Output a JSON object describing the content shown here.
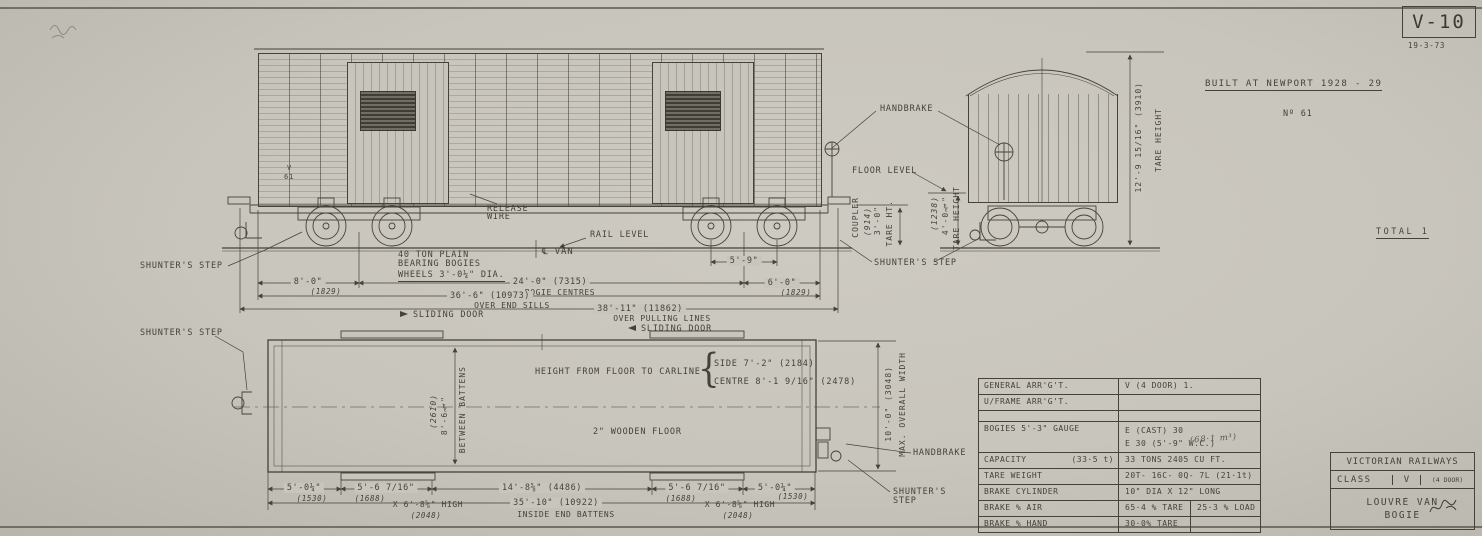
{
  "meta": {
    "drawing_no": "V-10",
    "date": "19-3-73",
    "built_at": "BUILT AT NEWPORT 1928 - 29",
    "unit_no": "Nº 61",
    "total": "TOTAL 1"
  },
  "side": {
    "shunters_step": "SHUNTER'S STEP",
    "bogies_line1": "40 TON PLAIN",
    "bogies_line2": "BEARING BOGIES",
    "wheels": "WHEELS 3'-0¼\" DIA.",
    "release_line1": "RELEASE",
    "release_line2": "WIRE",
    "rail_level": "RAIL LEVEL",
    "cl_van": "℄ VAN",
    "handbrake": "HANDBRAKE",
    "floor_level": "FLOOR LEVEL",
    "shunters_step_mid": "SHUNTER'S STEP",
    "body_class": "V",
    "body_no": "61",
    "dim_8ft": "8'-0\"",
    "dim_8ft_mm": "(1829)",
    "dim_5ft9": "5'-9\"",
    "dim_bogie_centres": "24'-0\" (7315)",
    "lbl_bogie_centres": "BOGIE CENTRES",
    "dim_6ft": "6'-0\"",
    "dim_6ft_mm": "(1829)",
    "dim_end_sills": "36'-6\" (10973)",
    "lbl_end_sills": "OVER END SILLS",
    "dim_pulling": "38'-11\" (11862)",
    "lbl_pulling": "OVER PULLING LINES",
    "coupler": "COUPLER",
    "coupler_mm": "(914)",
    "coupler_ht": "3'-0\"",
    "coupler_lbl": "TARE HT.",
    "floor_mm": "(1238)",
    "floor_ht": "4'-0¾\"",
    "floor_lbl": "TARE HEIGHT"
  },
  "end": {
    "tare_dim": "12'-9 15/16\" (3910)",
    "tare_lbl": "TARE HEIGHT"
  },
  "plan": {
    "sliding_door": "SLIDING DOOR",
    "carline_lbl": "HEIGHT FROM FLOOR TO CARLINE",
    "carline_side": "SIDE 7'-2\" (2184)",
    "carline_centre": "CENTRE 8'-1 9/16\" (2478)",
    "floor": "2\" WOODEN FLOOR",
    "bb_mm": "(2610)",
    "bb_dim": "8'-6¾\"",
    "bb_lbl": "BETWEEN BATTENS",
    "ow_dim": "10'-0\" (3048)",
    "ow_lbl": "MAX. OVERALL WIDTH",
    "handbrake": "HANDBRAKE",
    "shunters_step": "SHUNTER'S STEP",
    "ss_line1": "SHUNTER'S",
    "ss_line2": "STEP",
    "d1": "5'-0¼\"",
    "d1_mm": "(1530)",
    "d2": "5'-6 7/16\"",
    "d2_mm": "(1688)",
    "d2b": "X 6'-8⅝\" HIGH",
    "d2b_mm": "(2048)",
    "d3": "14'-8⅝\" (4486)",
    "d4": "5'-6 7/16\"",
    "d4_mm": "(1688)",
    "d4b": "X 6'-8⅝\" HIGH",
    "d4b_mm": "(2048)",
    "d5": "5'-0¼\"",
    "d5_mm": "(1530)",
    "total_dim": "35'-10\" (10922)",
    "total_lbl": "INSIDE END BATTENS"
  },
  "spec": {
    "rows": [
      {
        "label": "GENERAL ARR'G'T.",
        "v1": "V (4 DOOR) 1."
      },
      {
        "label": "U/FRAME ARR'G'T.",
        "v1": ""
      },
      {
        "label": "",
        "v1": ""
      },
      {
        "label": "BOGIES 5'-3\" GAUGE",
        "v1": "E (CAST) 30",
        "v1b": "E 30  (5'-9\" W.C.)"
      },
      {
        "label": "CAPACITY",
        "label2": "(33·5 t)",
        "v1": "33 TONS   2405 CU FT."
      },
      {
        "label": "TARE WEIGHT",
        "v1": "20T- 16C- 0Q- 7L  (21·1t)"
      },
      {
        "label": "BRAKE CYLINDER",
        "v1": "10\" DIA X 12\" LONG"
      },
      {
        "label": "BRAKE % AIR",
        "v1": "65·4 % TARE",
        "v2": "25·3 % LOAD"
      },
      {
        "label": "BRAKE % HAND",
        "v1": "30·0% TARE",
        "v2": ""
      }
    ],
    "pencil_note": "(68·1 m³)"
  },
  "title_block": {
    "railway": "VICTORIAN RAILWAYS",
    "class_lbl": "CLASS",
    "class_val": "V",
    "class_note": "(4 DOOR)",
    "name1": "LOUVRE VAN",
    "name2": "BOGIE"
  }
}
